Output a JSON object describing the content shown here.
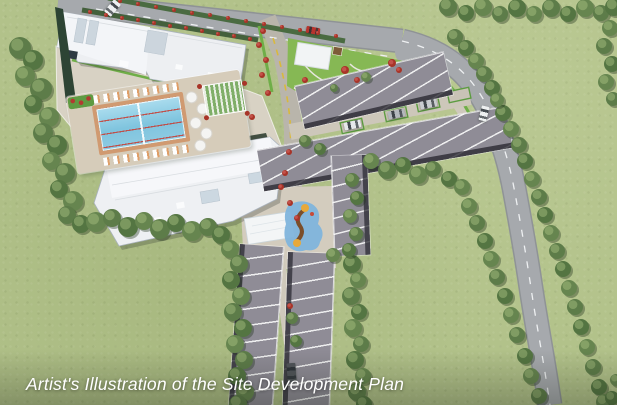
{
  "caption": {
    "text": "Artist's Illustration of the Site Development Plan"
  },
  "scene": {
    "description": "Aerial artist's rendering of a mixed residential site development plan",
    "landmarks": [
      "condo-building-north",
      "condo-building-south",
      "amenity-pool-deck",
      "lap-pool",
      "trellis-garden",
      "pocket-park-with-court",
      "gazebo",
      "townhouse-rows",
      "playground-splash-pad",
      "event-pavilion",
      "main-access-road",
      "curving-perimeter-road",
      "entry-branch-road",
      "perimeter-tree-line",
      "parked-cars",
      "delivery-truck",
      "red-car",
      "white-van"
    ],
    "colors": {
      "grass": "#b2c28a",
      "road": "#a6a9ad",
      "road_marking_white": "#eef0f2",
      "road_marking_yellow": "#d9b93c",
      "roof": "#8f8c96",
      "roof_eave": "#3c3b43",
      "building_white": "#edeff2",
      "pool": "#8fcbe4",
      "deck": "#d6ccba",
      "pavement_tan": "#cdc7ba",
      "tree": "#5d7c49",
      "verge_green": "#6fae48",
      "park_lawn": "#86b854",
      "flower_red": "#b23a30",
      "caption": "#ffffff"
    }
  }
}
